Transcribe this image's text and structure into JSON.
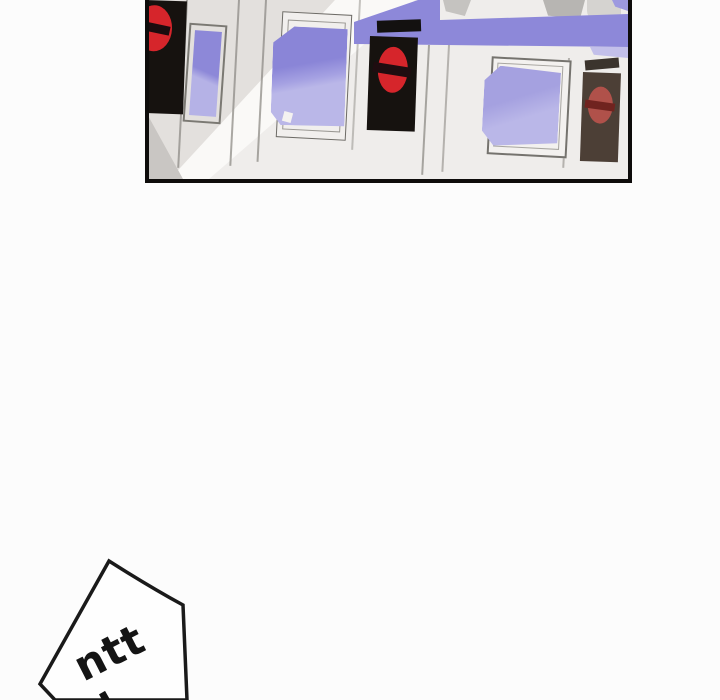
{
  "page": {
    "background_color": "#fcfcfc",
    "description": "Webtoon/manhwa page fragment: top panel of subway ticket gates, blank gutter, speech bubble with sound effect cut off at bottom edge"
  },
  "panel": {
    "border_color": "#0e0c0b",
    "background_color": "#efedeb",
    "scene": "row of subway fare gates with no-entry signs, diagonal light beam across left side",
    "colors": {
      "band_purple": "#8d88d9",
      "band_purple_light": "#c3c0ea",
      "screen_purple_dark": "#8a85d7",
      "screen_purple_light": "#bab7e8",
      "gate_gray": "#e3e0dd",
      "beam_white": "#faf9f7",
      "corner_shadow_gray": "#c9c6c3",
      "sign_black": "#16120f",
      "no_entry_red": "#d6252b",
      "shadow_sign_brown": "#4c3f36",
      "no_entry_red_dim": "#b0514a"
    },
    "no_entry_sign_count": 3,
    "screen_count": 3
  },
  "speech_bubble": {
    "fill": "#fefefe",
    "stroke": "#1a1a1a",
    "sfx_text": "ntt"
  }
}
